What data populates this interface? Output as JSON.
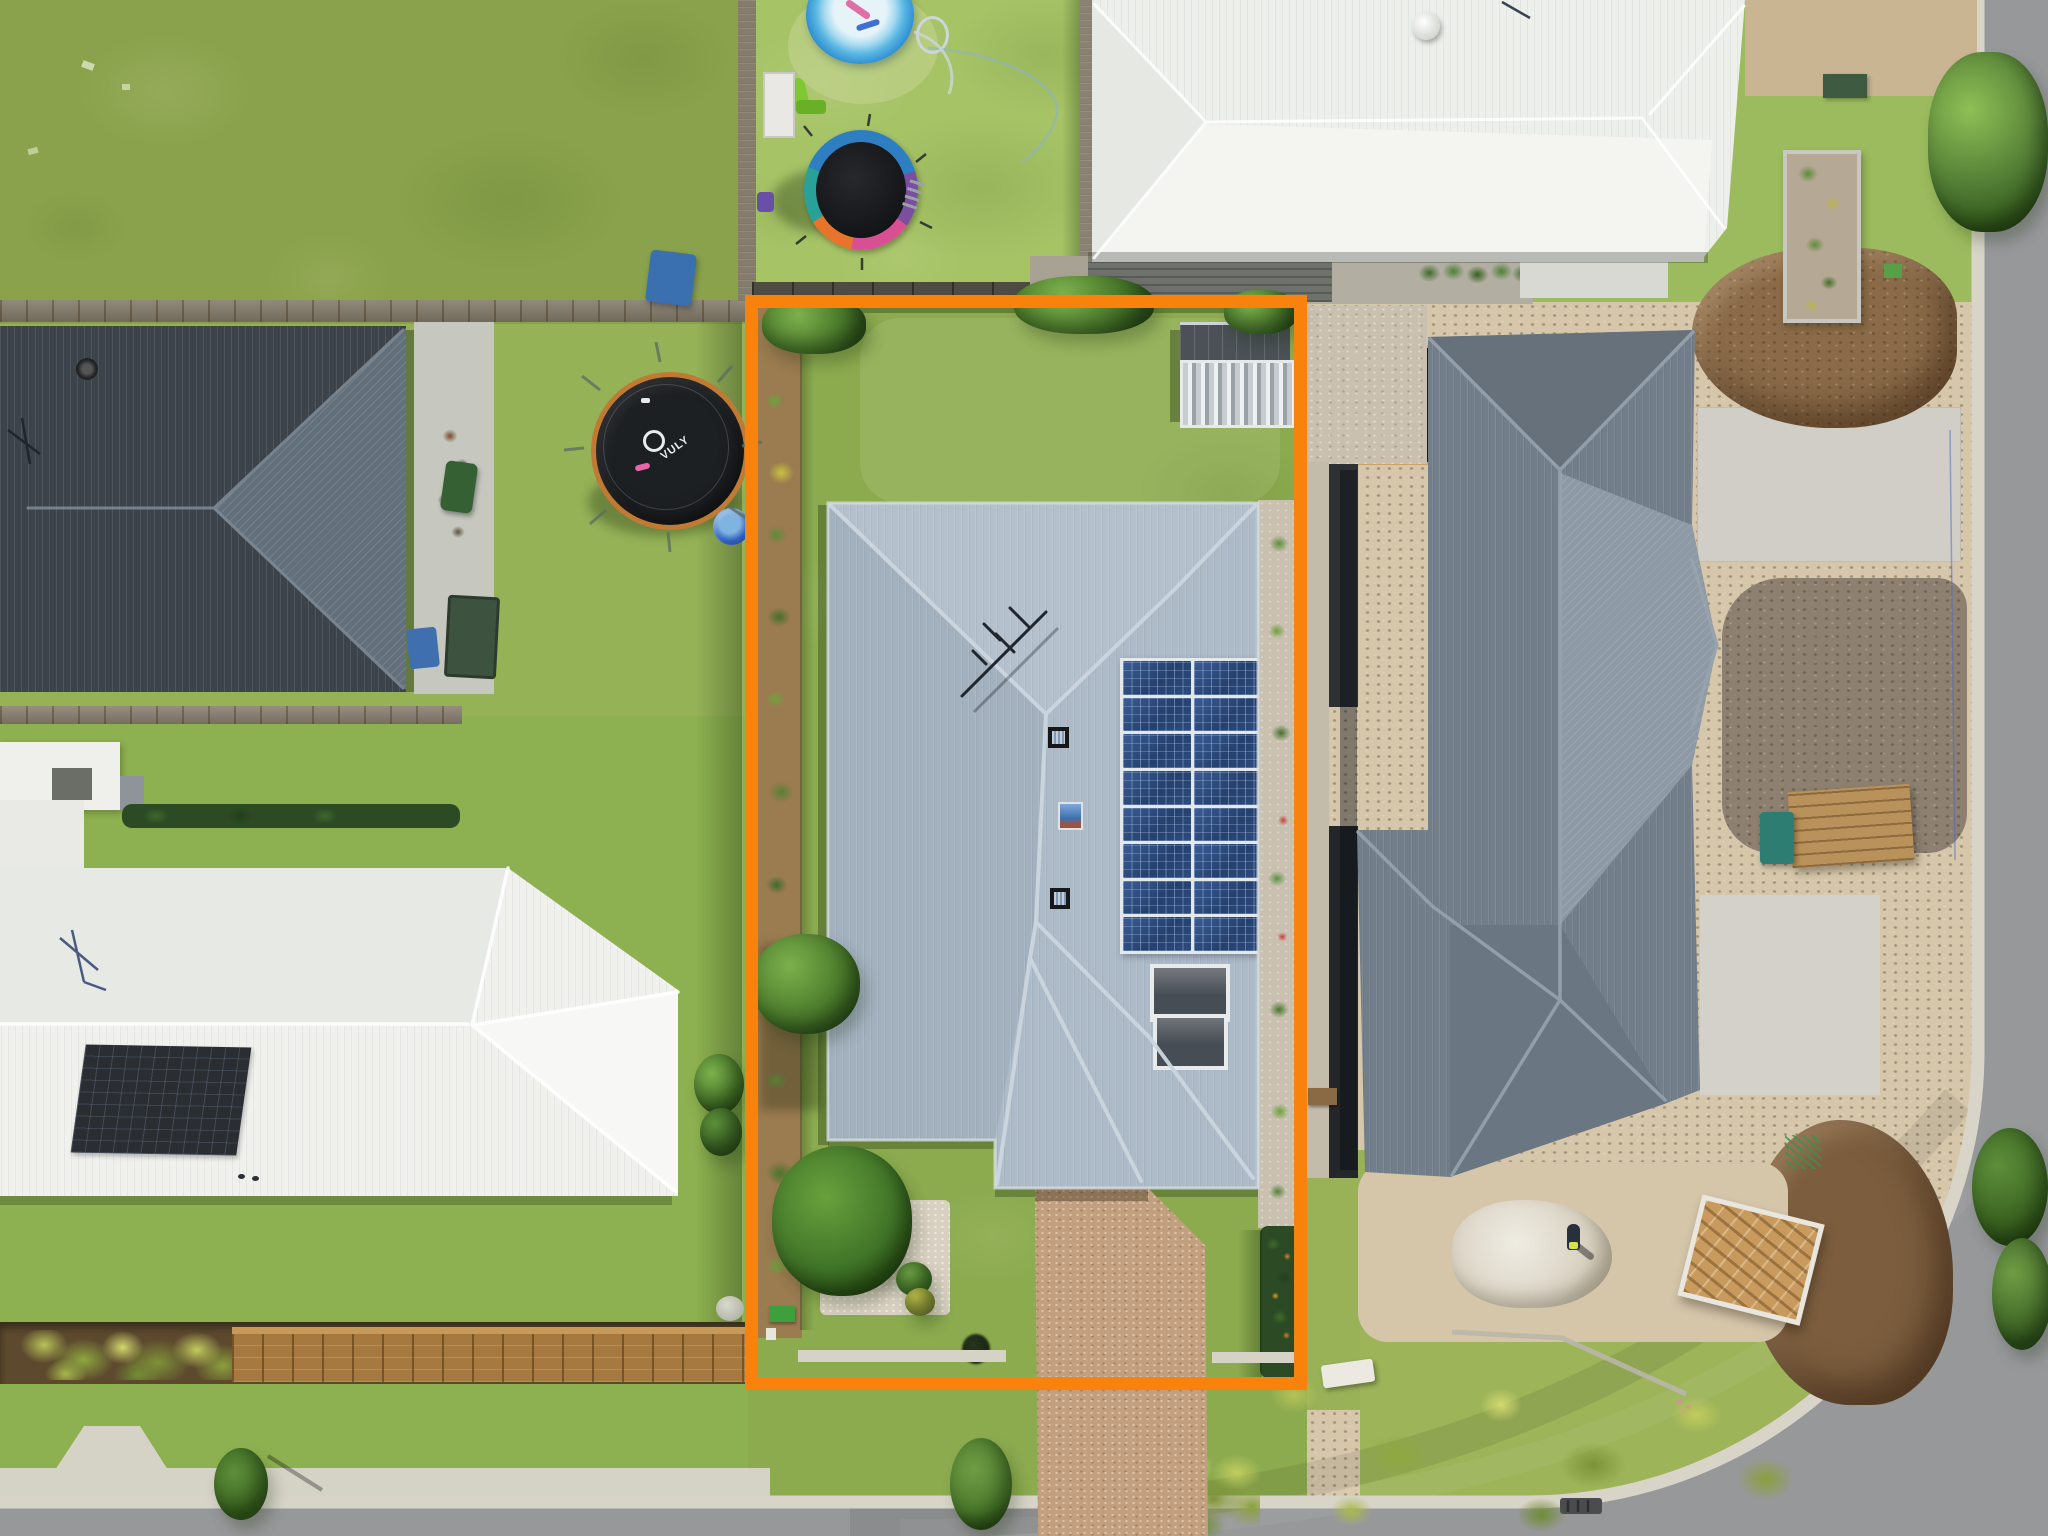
{
  "scene": {
    "title": "Aerial drone photograph of a suburban property for sale",
    "description": "Top-down drone view of a residential lot outlined with an orange boundary rectangle. The highlighted property has a light grey corrugated hip-roof house with rooftop solar panels, a rear garden shed, lawns, garden beds and an exposed-aggregate driveway meeting a street at the bottom. Neighbouring houses: dark charcoal roof (top left), cream/white roof (bottom left), white roof (top right) and a large grey roof home beside a construction lot (right) with dirt mounds and a curving street corner."
  },
  "palette": {
    "boundary_orange": "#f8820c",
    "roof_main": "#adbbc8",
    "roof_main_north": "#b4c1cd",
    "roof_main_west": "#a3b1bf",
    "ridge_cap": "#ccd6de",
    "roof_dark_charcoal": "#3c434b",
    "roof_dark_lit": "#62707c",
    "roof_white": "#f0f1ed",
    "roof_white_bright": "#f7f8f5",
    "roof_topright_white": "#edefeb",
    "roof_right_grey": "#727e89",
    "roof_right_lit": "#8d99a4",
    "solar_panel_blue": "#2c4a7c",
    "solar_frame_white": "#e3e8ec",
    "hot_water_panel": "#474d54",
    "grass_base": "#8cab4f",
    "grass_bright": "#a6c366",
    "grass_olive": "#8aa24b",
    "driveway_aggregate": "#c2a07f",
    "road_asphalt": "#97989a",
    "kerb_concrete": "#d8d4c8",
    "footpath_concrete": "#d5d2c6",
    "dirt_brown": "#8a6a48",
    "soil_dark": "#8d8070",
    "sand_light": "#d6c7ab",
    "gravel_light": "#c9c0b0",
    "mulch_brown": "#9b7b50",
    "pebble_bed_white": "#d8d0c0",
    "hedge_green": "#2c4a24",
    "pool_ring_blue": "#2f8ed0",
    "pool_water": "#cfeaf5",
    "trampoline_mat_black": "#1d2023",
    "vuly_rim_orange": "#c07a33",
    "timber": "#b9915a",
    "shed_roof_grey": "#4b5157",
    "fence_wood": "#857c6b"
  },
  "main_house": {
    "roof_type": "grey corrugated metal hip roof",
    "solar_array": {
      "rows": 8,
      "cols": 2,
      "panel_count": 16
    },
    "roof_features": [
      "tv-antenna",
      "two roof vents",
      "skylight",
      "two solar hot water panels"
    ],
    "garage": "attached, facing street with aggregate driveway",
    "yard_features": [
      "rear garden shed with pergola",
      "side garden beds",
      "white pebble front garden",
      "palm trees",
      "front path",
      "green utility box"
    ]
  },
  "objects": {
    "vuly_trampoline": {
      "brand": "Vuly",
      "logo_text": "VULY",
      "mat": "black",
      "rim": "orange"
    },
    "colourful_trampoline": {
      "rim_colors": [
        "#2e7fc2",
        "#7a4fa0",
        "#d94f93",
        "#e8732a",
        "#2aa198"
      ]
    },
    "inflatable_pool": {
      "color": "blue",
      "accessories": [
        "pink noodle",
        "blue noodle",
        "hose"
      ]
    },
    "kiddie_pool": {
      "color": "blue"
    },
    "construction_items": [
      "dirt mounds",
      "white rubble pile",
      "timber crate",
      "timber stack",
      "concrete pads",
      "worker"
    ],
    "street_items": [
      "storm drains",
      "street trees",
      "kerb ramp",
      "ornamental grasses"
    ]
  },
  "neighbours": {
    "top_left": "charcoal hip roof house with side patio, mower and trailer",
    "bottom_left": "cream white hip roof house with dark solar panel and timber front retaining wall",
    "top_centre": "backyard with inflatable pool, colourful trampoline, slide",
    "top_right": "white roof house with rear deck and raised garden bed",
    "right": "large grey roof house on construction lot"
  }
}
